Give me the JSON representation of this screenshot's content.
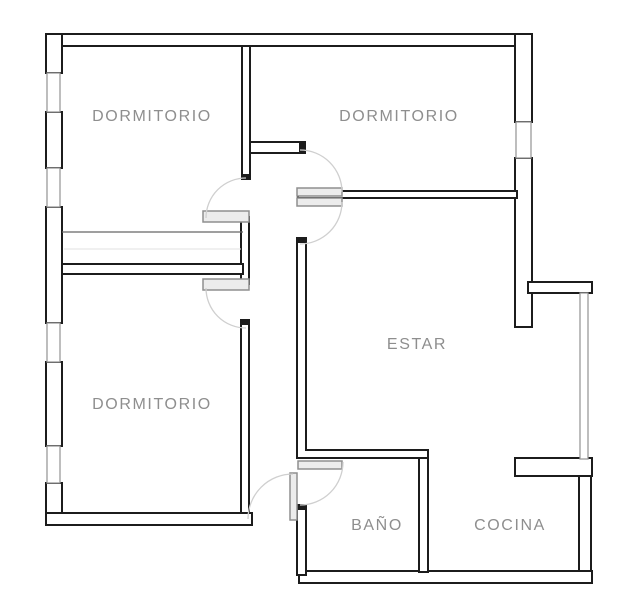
{
  "floorplan": {
    "background_color": "#ffffff",
    "colors": {
      "background": "#ffffff",
      "wall_stroke": "#1c1c1c",
      "window_stroke": "#9a9a9a",
      "door_leaf_stroke": "#8f8f8f",
      "door_leaf_fill": "#ececec",
      "arc_stroke": "#cfcfcf",
      "label_text": "#8e8e8e"
    },
    "rooms": [
      {
        "id": "dormitorio-top-left",
        "label": "DORMITORIO"
      },
      {
        "id": "dormitorio-top-right",
        "label": "DORMITORIO"
      },
      {
        "id": "dormitorio-bottom-left",
        "label": "DORMITORIO"
      },
      {
        "id": "estar",
        "label": "ESTAR"
      },
      {
        "id": "bano",
        "label": "BAÑO"
      },
      {
        "id": "cocina",
        "label": "COCINA"
      }
    ]
  }
}
